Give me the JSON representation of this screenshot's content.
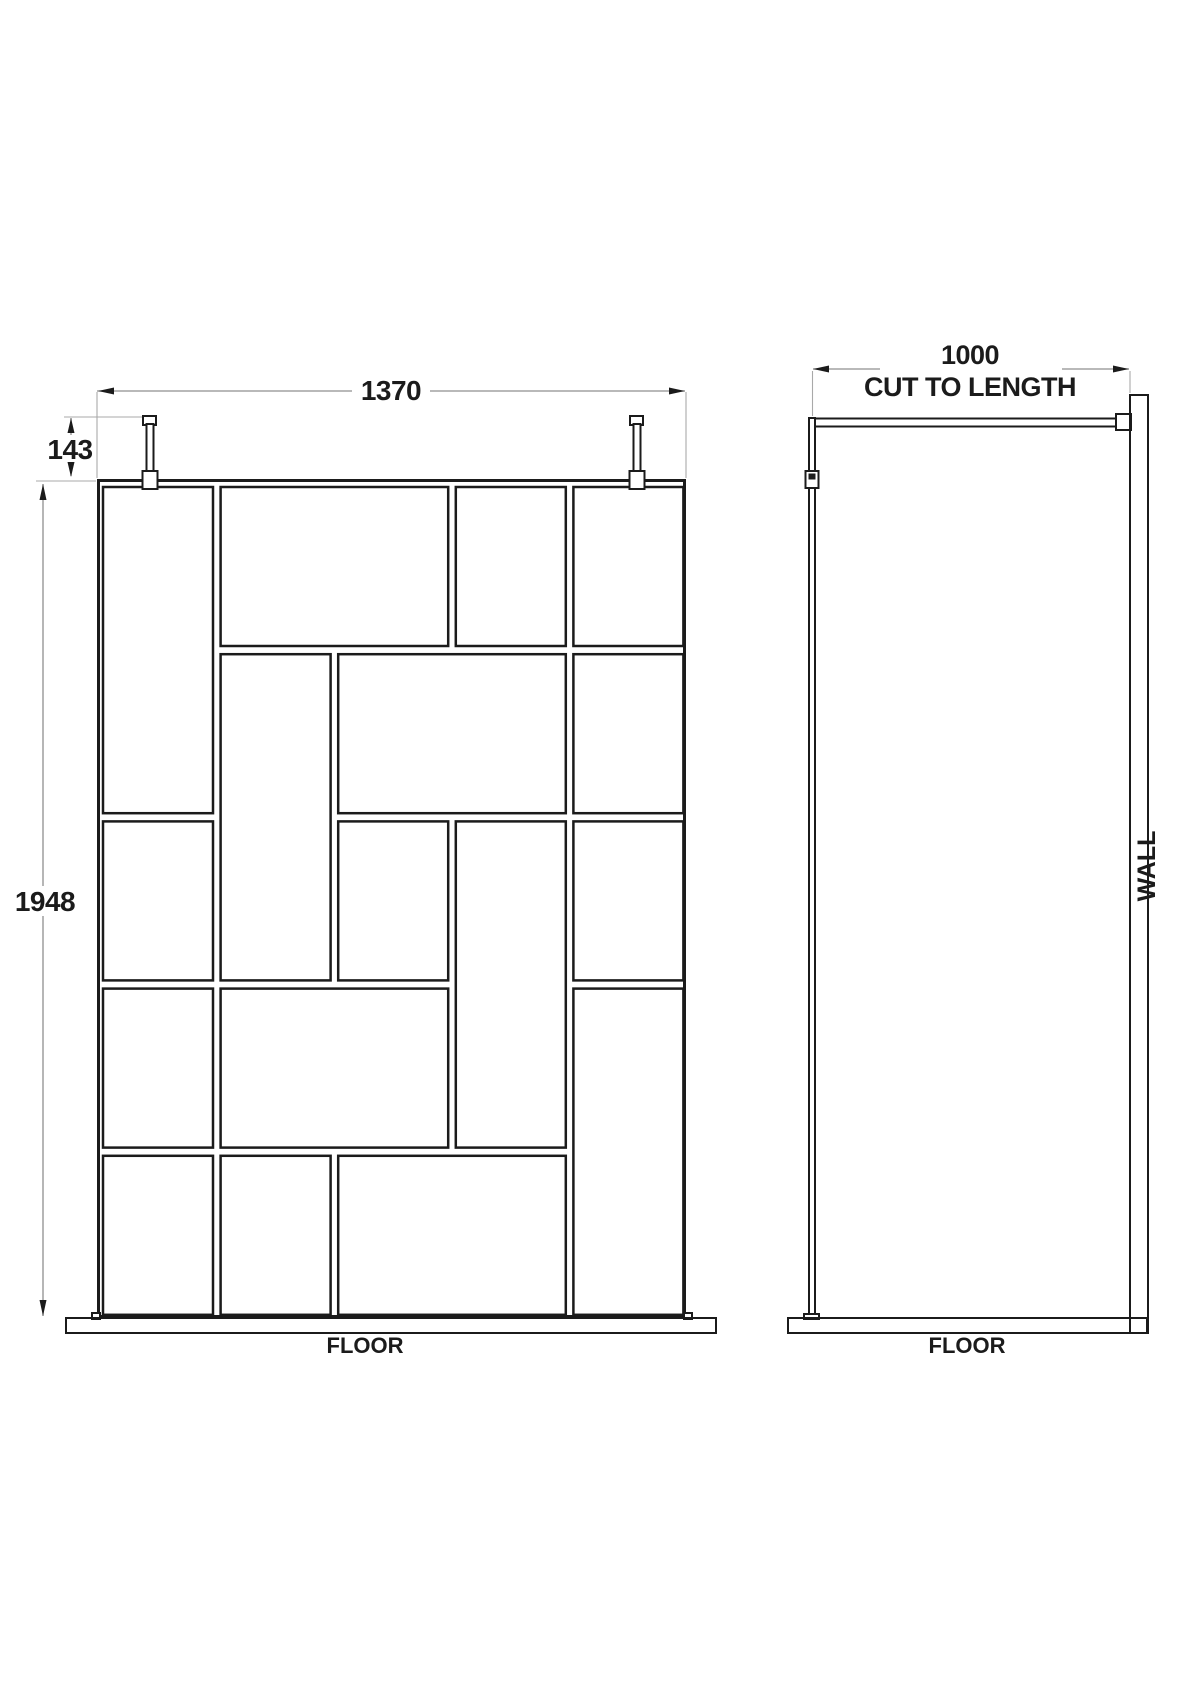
{
  "drawing": {
    "type": "walk-in shower screen installation diagram",
    "front_view": {
      "width_dim": "1370",
      "post_drop_dim": "143",
      "height_dim": "1948",
      "floor_label": "FLOOR",
      "grid": {
        "cols": 5,
        "rows": 5,
        "panes": [
          [
            1,
            1,
            1,
            2
          ],
          [
            2,
            1,
            2,
            1
          ],
          [
            4,
            1,
            1,
            1
          ],
          [
            5,
            1,
            1,
            1
          ],
          [
            2,
            2,
            1,
            2
          ],
          [
            3,
            2,
            2,
            1
          ],
          [
            5,
            2,
            1,
            1
          ],
          [
            1,
            3,
            1,
            1
          ],
          [
            3,
            3,
            1,
            1
          ],
          [
            4,
            3,
            1,
            2
          ],
          [
            5,
            3,
            1,
            1
          ],
          [
            1,
            4,
            1,
            1
          ],
          [
            2,
            4,
            2,
            1
          ],
          [
            5,
            4,
            1,
            2
          ],
          [
            1,
            5,
            1,
            1
          ],
          [
            2,
            5,
            1,
            1
          ],
          [
            3,
            5,
            2,
            1
          ]
        ]
      }
    },
    "side_view": {
      "depth_dim": "1000",
      "depth_note": "CUT TO LENGTH",
      "wall_label": "WALL",
      "floor_label": "FLOOR"
    },
    "colors": {
      "line": "#1b1b1b",
      "dimension": "#8f8f8f",
      "background": "#ffffff"
    }
  }
}
